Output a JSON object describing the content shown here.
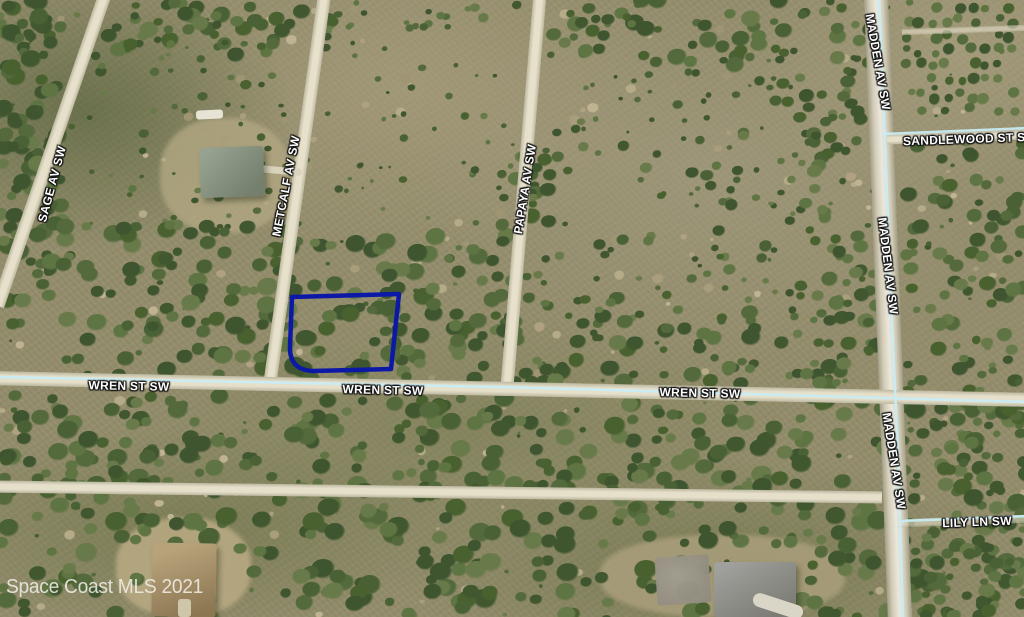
{
  "map": {
    "type": "aerial-parcel-photo",
    "watermark": "Space Coast MLS 2021",
    "colors": {
      "parcel_outline": "#0c19a6",
      "road_overlay_line": "#c9edf5",
      "label_text": "#ffffff"
    },
    "road_labels": {
      "sage": "SAGE AV SW",
      "metcalf": "METCALF AV SW",
      "papaya": "PAPAYA AV SW",
      "madden_top": "MADDEN AV SW",
      "madden_mid": "MADDEN AV SW",
      "madden_bottom": "MADDEN AV SW",
      "sandlewood": "SANDLEWOOD ST SW",
      "wren_left": "WREN ST SW",
      "wren_center": "WREN ST SW",
      "wren_right": "WREN ST SW",
      "lily": "LILY LN SW"
    }
  }
}
